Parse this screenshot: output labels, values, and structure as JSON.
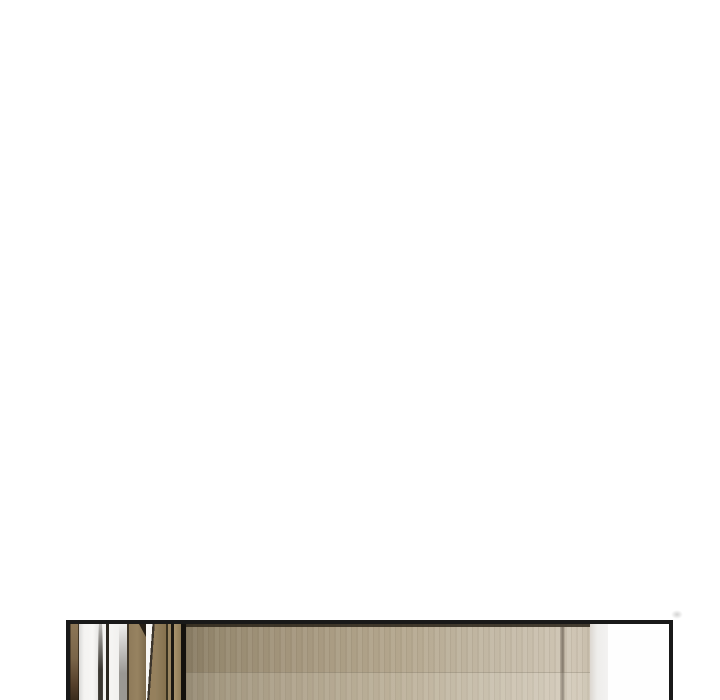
{
  "page": {
    "kind": "comic-reader-page",
    "background": "#ffffff",
    "visible_text": [],
    "description": "Blank white reader page scrolled so that only the top sliver of the next illustrated panel is visible at the bottom edge."
  },
  "colors": {
    "ink": "#191919",
    "paper": "#ffffff",
    "wood-main": "#8f7b5a",
    "wood-dark": "#3f3526",
    "door-left": "#877a62",
    "door-mid": "#b3a68d",
    "door-right": "#cfc5b4",
    "wall-white": "#f5f4f2",
    "wall-gray-line": "#b0aeab",
    "gray-strip": "#eeedeb",
    "smudge": "#a8a8a6"
  },
  "panel": {
    "description": "Top edge of an interior illustration: perspective hallway with dark wooden pillars, white walls and black door-frame lines on the left; a large pale wood-grain door panel with a vertical seam on the right, ending in a light grey wall strip and white margin inside a black panel border.",
    "border_color": "#191919",
    "border_thickness_px": 4
  }
}
